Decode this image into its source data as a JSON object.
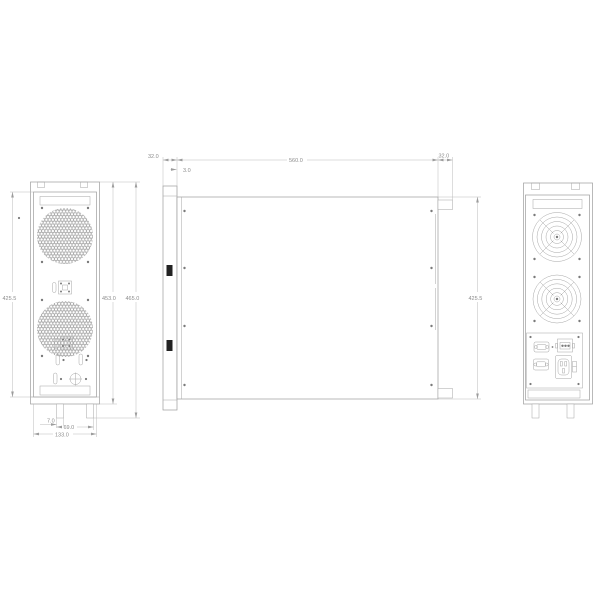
{
  "drawing": {
    "description_note": "",
    "colors": {
      "line": "#9c9c9c",
      "dim_line": "#b3b3b3",
      "dim_text": "#8c8c8c",
      "slot_fill": "#222222",
      "background": "#ffffff"
    },
    "dimensions": {
      "front": {
        "panel_height": "425.5",
        "chassis_height": "453.0",
        "overall_height": "465.0",
        "foot_offset": "7.0",
        "foot_spacing": "69.0",
        "overall_width": "133.0"
      },
      "side": {
        "front_ear_depth": "32.0",
        "body_depth": "560.0",
        "rear_tab_depth": "32.0",
        "panel_thickness": "3.0",
        "panel_height": "425.5"
      }
    }
  }
}
